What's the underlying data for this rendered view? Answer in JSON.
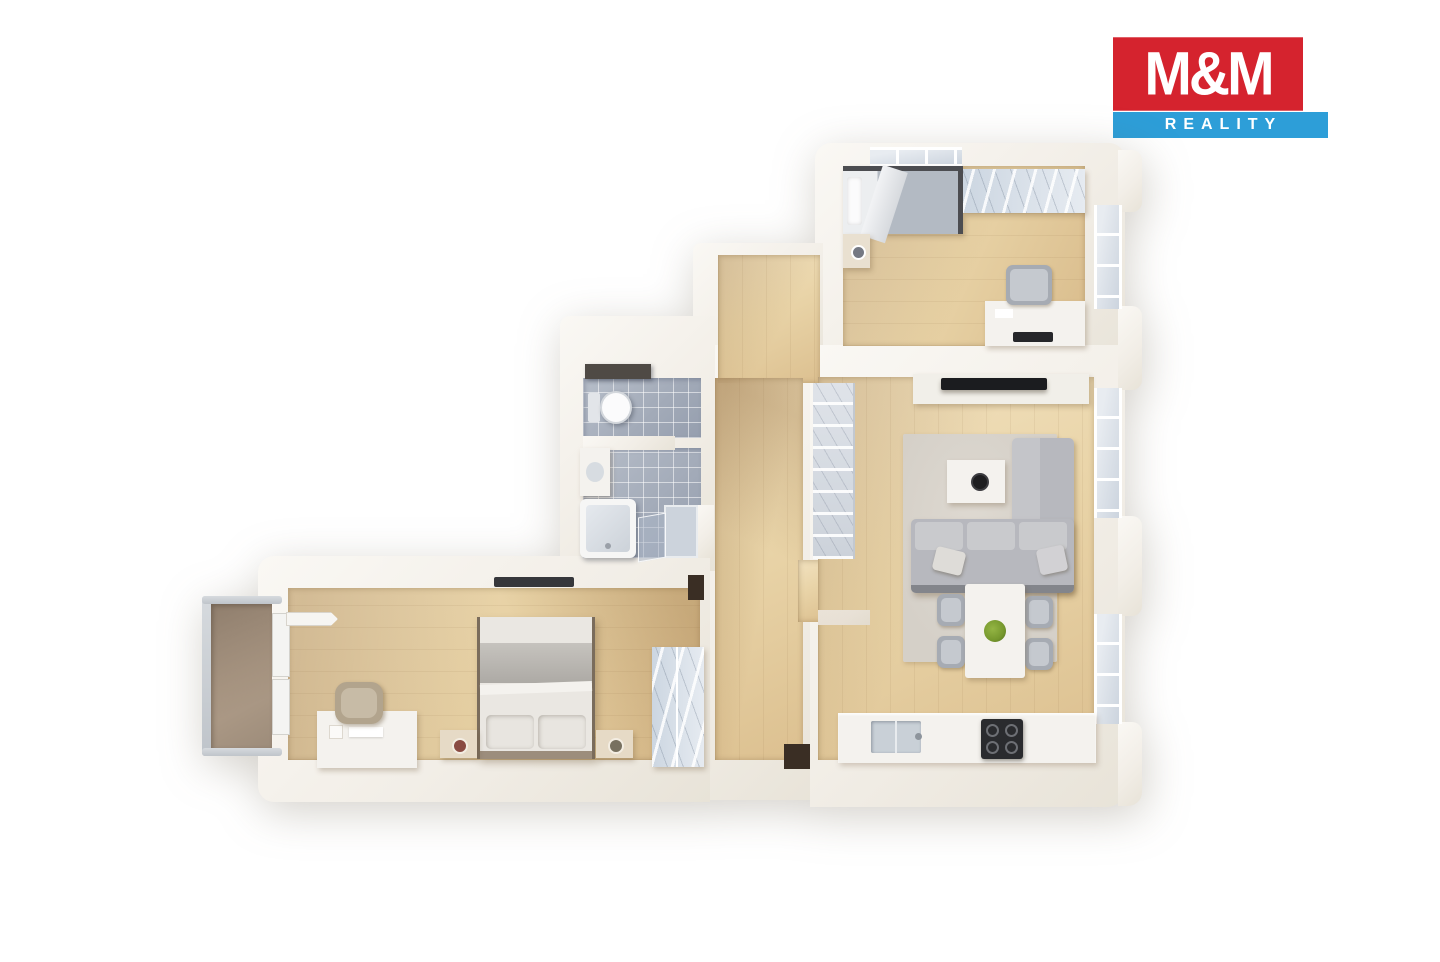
{
  "logo": {
    "mm": "M&M",
    "reality": "REALITY"
  },
  "theme": {
    "bg": "#ffffff",
    "logo-red": "#d5232e",
    "logo-blue": "#2d9ed8",
    "logo-text": "#ffffff",
    "furn-white": "#f4f2ee",
    "appliance-dark": "#2a2b2e",
    "tv-dark": "#1b1c1f",
    "sofa": "#b7b8be",
    "sofa-light": "#c9cacd",
    "rug": "#d5d0c8",
    "plant-green": "#76982d",
    "shadow-warm": "rgba(146,108,62,0.30)",
    "niche-dark": "#3a2e24"
  }
}
